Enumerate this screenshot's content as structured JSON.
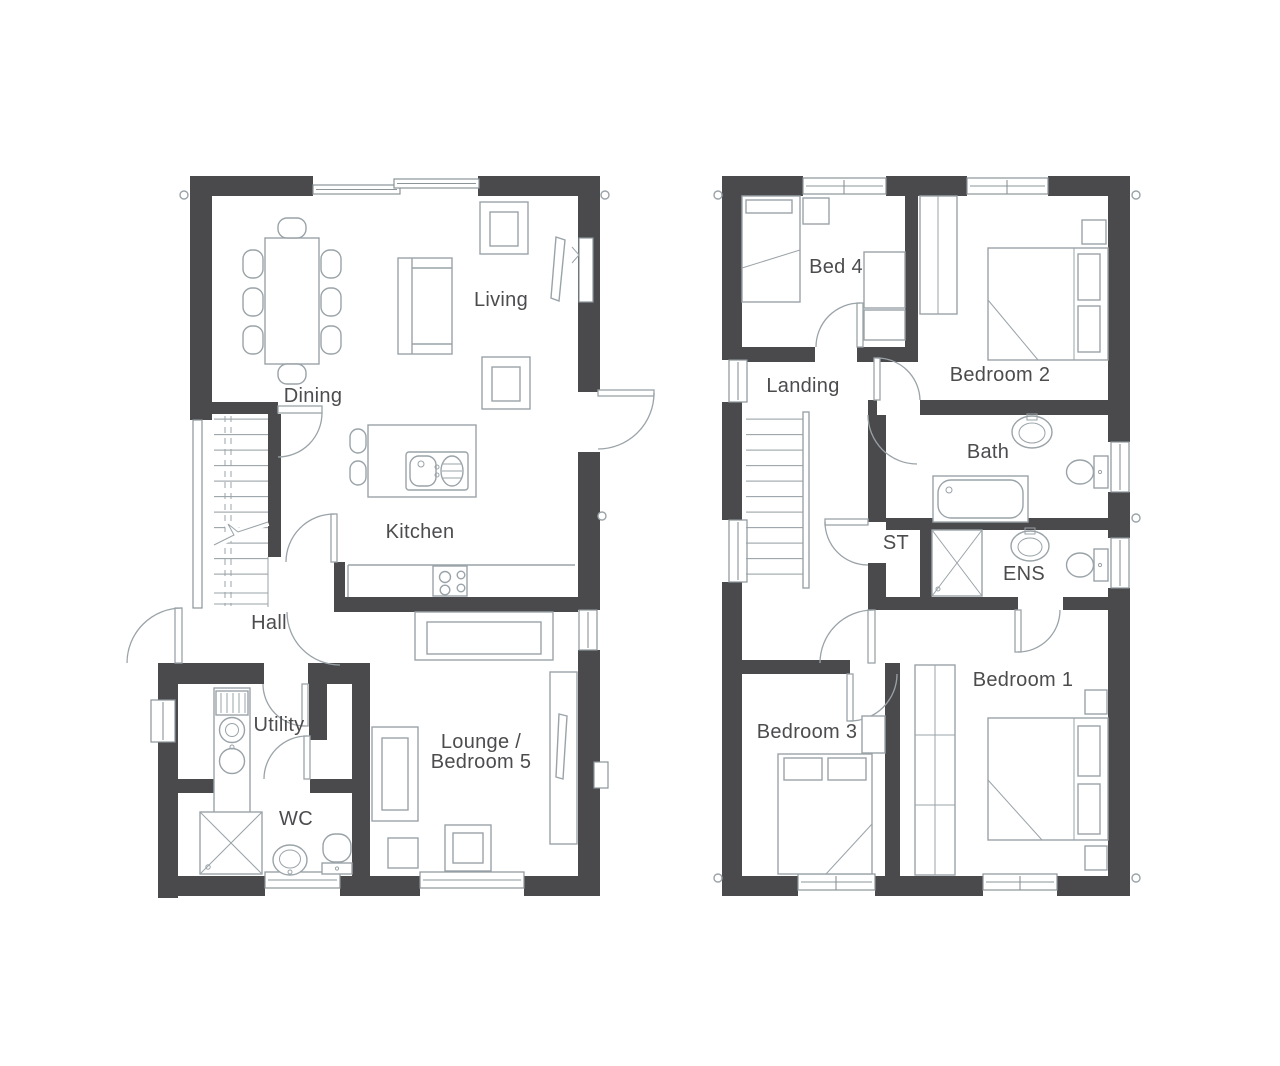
{
  "palette": {
    "wall": "#4a4a4c",
    "furniture_line": "#9aa3a8",
    "window_line": "#8b9499",
    "text": "#4c4c4f",
    "background": "#ffffff"
  },
  "floors": [
    {
      "id": "ground-floor",
      "rooms": [
        {
          "id": "dining",
          "label": "Dining"
        },
        {
          "id": "living",
          "label": "Living"
        },
        {
          "id": "kitchen",
          "label": "Kitchen"
        },
        {
          "id": "hall",
          "label": "Hall"
        },
        {
          "id": "utility",
          "label": "Utility"
        },
        {
          "id": "wc",
          "label": "WC"
        },
        {
          "id": "lounge-bedroom5",
          "label": "Lounge /",
          "label2": "Bedroom 5"
        }
      ]
    },
    {
      "id": "first-floor",
      "rooms": [
        {
          "id": "bed4",
          "label": "Bed 4"
        },
        {
          "id": "bedroom2",
          "label": "Bedroom 2"
        },
        {
          "id": "landing",
          "label": "Landing"
        },
        {
          "id": "bath",
          "label": "Bath"
        },
        {
          "id": "st",
          "label": "ST"
        },
        {
          "id": "ens",
          "label": "ENS"
        },
        {
          "id": "bedroom1",
          "label": "Bedroom 1"
        },
        {
          "id": "bedroom3",
          "label": "Bedroom 3"
        }
      ]
    }
  ]
}
